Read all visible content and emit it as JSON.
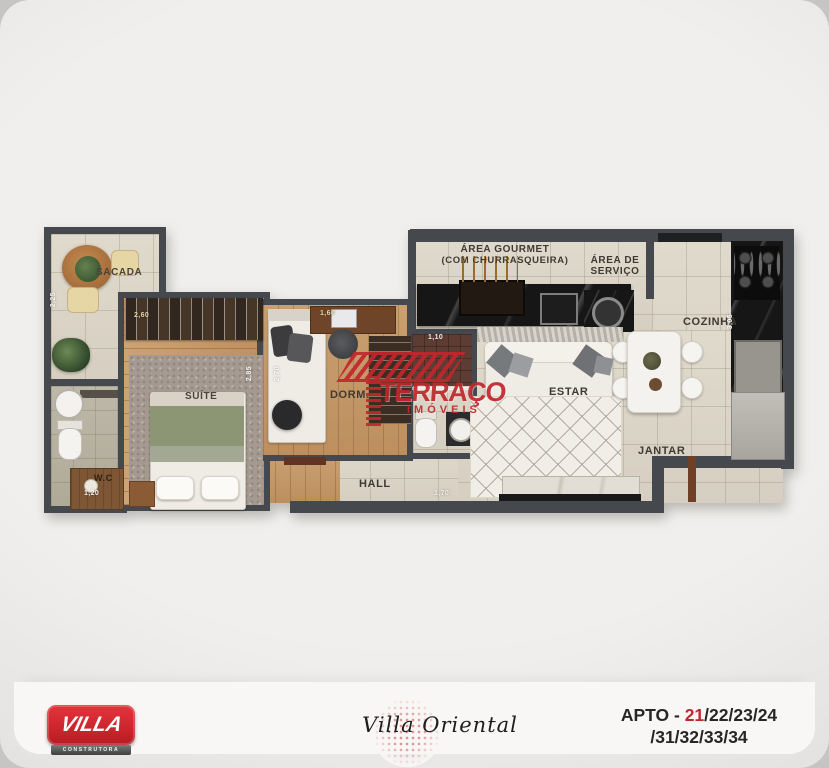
{
  "plan": {
    "sacada": {
      "label": "SACADA",
      "dim_left": "2,25"
    },
    "wc": {
      "label": "W.C",
      "dim": "1,20"
    },
    "suite": {
      "label": "SUÍTE",
      "dim_closet": "2,60",
      "dim_right": "2,85"
    },
    "dorm": {
      "label": "DORM.",
      "dim_top": "1,60",
      "dim_left": "2,70"
    },
    "bathroom": {
      "dim_top": "1,10"
    },
    "hall": {
      "label": "HALL",
      "dim": "1,70"
    },
    "estar": {
      "label": "ESTAR"
    },
    "jantar": {
      "label": "JANTAR"
    },
    "cozinha": {
      "label": "COZINHA",
      "dim_counter": "3,05"
    },
    "area_gourmet": {
      "label_line1": "ÁREA GOURMET",
      "label_line2": "(COM CHURRASQUEIRA)"
    },
    "area_servico": {
      "label_line1": "ÁREA DE",
      "label_line2": "SERVIÇO"
    }
  },
  "watermark": {
    "brand": "TERRAÇO",
    "subtitle": "IMÓVEIS",
    "color": "#c1272d"
  },
  "footer": {
    "builder": {
      "name": "VILLA",
      "tagline": "CONSTRUTORA",
      "brand_color": "#d01f28"
    },
    "project_name": "Villa Oriental",
    "apto": {
      "prefix": "APTO - ",
      "unit_highlight": "21",
      "units_rest": "/22/23/24",
      "units_line2": "/31/32/33/34",
      "highlight_color": "#c0272d"
    }
  }
}
